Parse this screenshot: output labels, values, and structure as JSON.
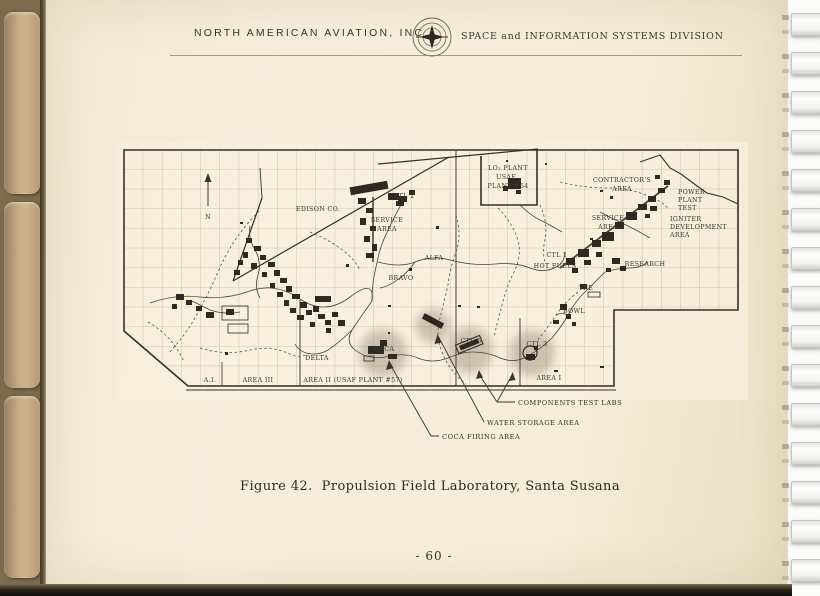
{
  "header": {
    "company": "NORTH AMERICAN AVIATION, INC.",
    "division": "SPACE and INFORMATION SYSTEMS DIVISION"
  },
  "map": {
    "north": "N",
    "labels": {
      "edison": "EDISON CO.",
      "ctl2": "CTL 2",
      "service_west_1": "SERVICE",
      "service_west_2": "AREA",
      "lo2_1": "LO₂ PLANT",
      "lo2_2": "USAF",
      "lo2_3": "PLANT #64",
      "contractors_1": "CONTRACTOR'S",
      "contractors_2": "AREA",
      "power_1": "POWER",
      "power_2": "PLANT",
      "power_3": "TEST",
      "igniter_1": "IGNITER",
      "igniter_2": "DEVELOPMENT",
      "igniter_3": "AREA",
      "service_east_1": "SERVICE",
      "service_east_2": "AREA",
      "ctl1": "CTL 1",
      "hot_fuels": "HOT FUELS",
      "research": "RESEARCH",
      "tre": "TRE",
      "bowl": "BOWL",
      "alfa": "ALFA",
      "bravo": "BRAVO",
      "coca": "COCA",
      "delta": "DELTA",
      "ctl5": "CTL 5",
      "ctl3": "CTL 3",
      "a1": "A.I.",
      "area_iii": "AREA III",
      "area_ii": "AREA II (USAF PLANT #57)",
      "area_i": "AREA I"
    },
    "callouts": {
      "components": "COMPONENTS TEST LABS",
      "water": "WATER STORAGE AREA",
      "coca_firing": "COCA FIRING AREA"
    }
  },
  "figure": {
    "caption": "Figure 42.  Propulsion Field Laboratory, Santa Susana",
    "page_number": "- 60 -"
  },
  "colors": {
    "page": "#f5edd8",
    "ink": "#3c352a",
    "tab": "#c6ad85"
  }
}
